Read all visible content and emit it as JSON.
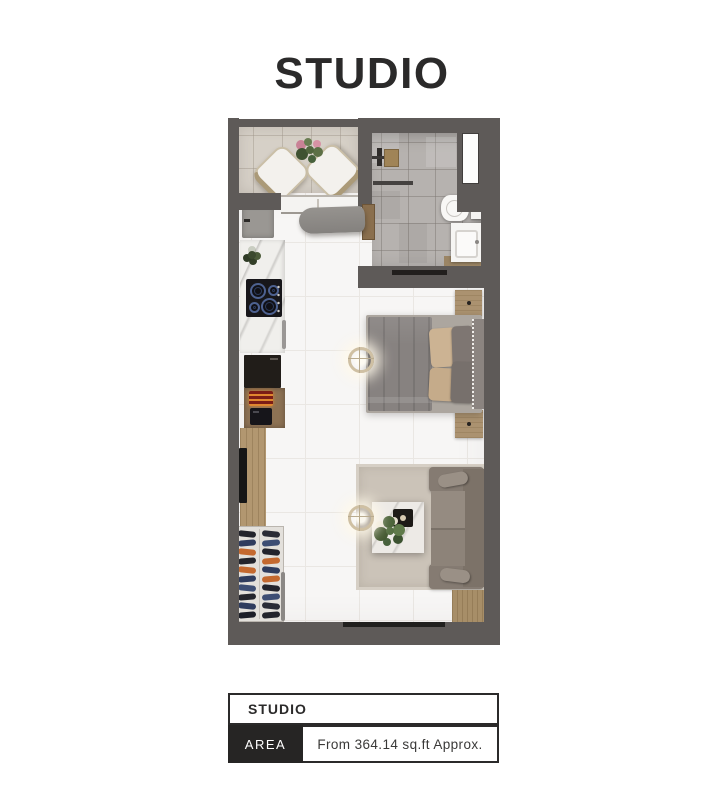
{
  "title": "STUDIO",
  "info_table": {
    "name": "STUDIO",
    "rows": [
      {
        "label": "AREA",
        "value": "From 364.14 sq.ft Approx."
      }
    ]
  },
  "colors": {
    "wall": "#5e5a58",
    "page_bg": "#ffffff",
    "text": "#2b2a2a",
    "table_label_bg": "#262524",
    "table_label_text": "#ffffff",
    "main_floor": "#f7f6f5",
    "main_floor_line": "#eae7e3",
    "balcony_floor": "#d6d0c7",
    "bath_floor": "#b6b2af",
    "rug": "#cbc3b8",
    "sofa": "#958b81",
    "bed_blanket": "#878280",
    "pillow_beige": "#ccb393",
    "wood": "#ab9270",
    "marble": "#f0efec",
    "shoe_orange": "#c4692f",
    "shoe_navy": "#2f3c5e"
  },
  "shoe_rack": {
    "columns": [
      [
        "#23242c",
        "#2f3c5e",
        "#c4692f",
        "#23242c",
        "#c4692f",
        "#2f3c5e",
        "#3d4e74",
        "#23242c",
        "#2f3c5e",
        "#1d1f28"
      ],
      [
        "#2a2c36",
        "#3d4e74",
        "#23242c",
        "#c4692f",
        "#2f3c5e",
        "#c4692f",
        "#23242c",
        "#3d4e74",
        "#2a2c36",
        "#23242c"
      ]
    ]
  }
}
